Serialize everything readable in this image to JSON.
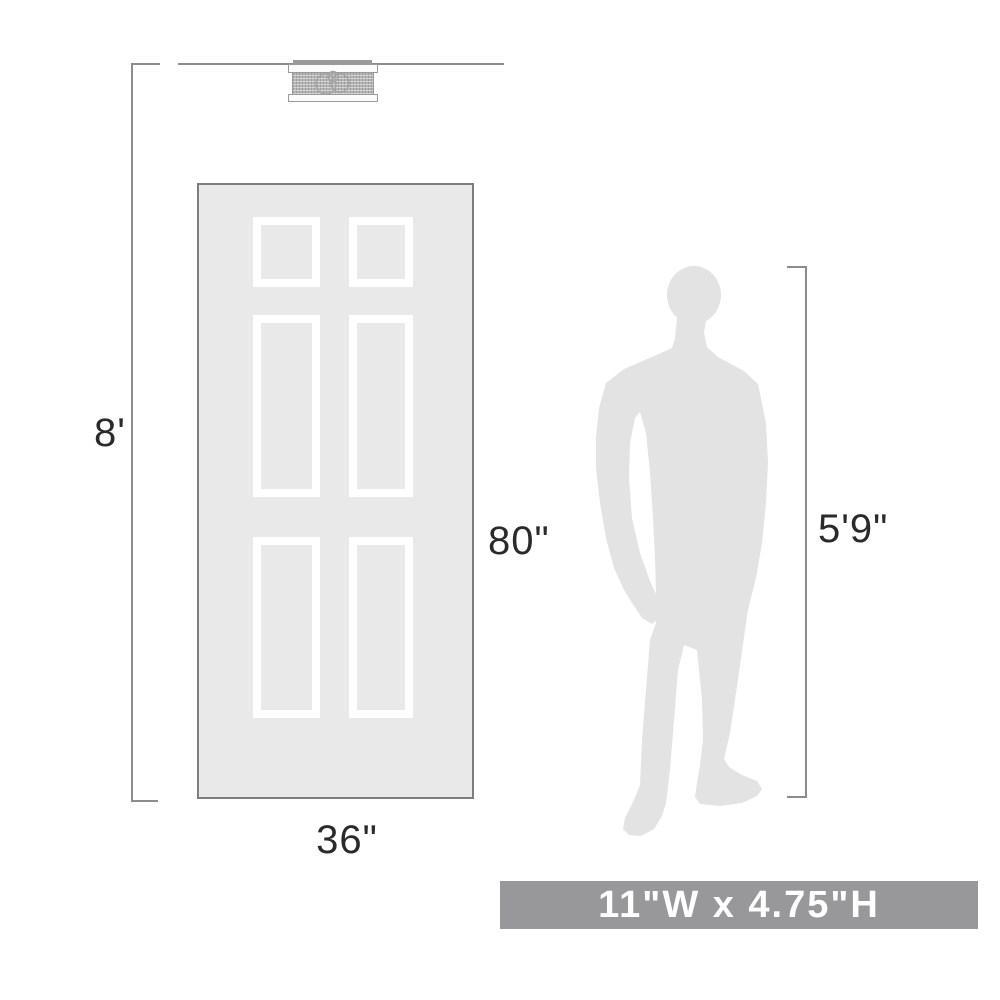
{
  "labels": {
    "ceiling_height": "8'",
    "door_height": "80\"",
    "door_width": "36\"",
    "person_height": "5'9\"",
    "fixture_size": "11\"W x 4.75\"H"
  },
  "diagram": {
    "subject": "flush-mount ceiling light fixture scale reference",
    "door_panels": 6,
    "person": "standing man silhouette"
  },
  "colors": {
    "line": "#8c8c8c",
    "text": "#2b2a2b",
    "door_fill": "#e9e9e9",
    "door_border": "#7d7d7d",
    "panel": "#ffffff",
    "silhouette": "#e3e3e4",
    "banner_bg": "#98989b",
    "banner_text": "#ffffff",
    "mesh": "#b5b5b5",
    "rim": "#fbfbfb",
    "rim_border": "#9b9b9b",
    "canopy": "#9a9a9a",
    "bulb_outline": "#a3a3a3"
  }
}
